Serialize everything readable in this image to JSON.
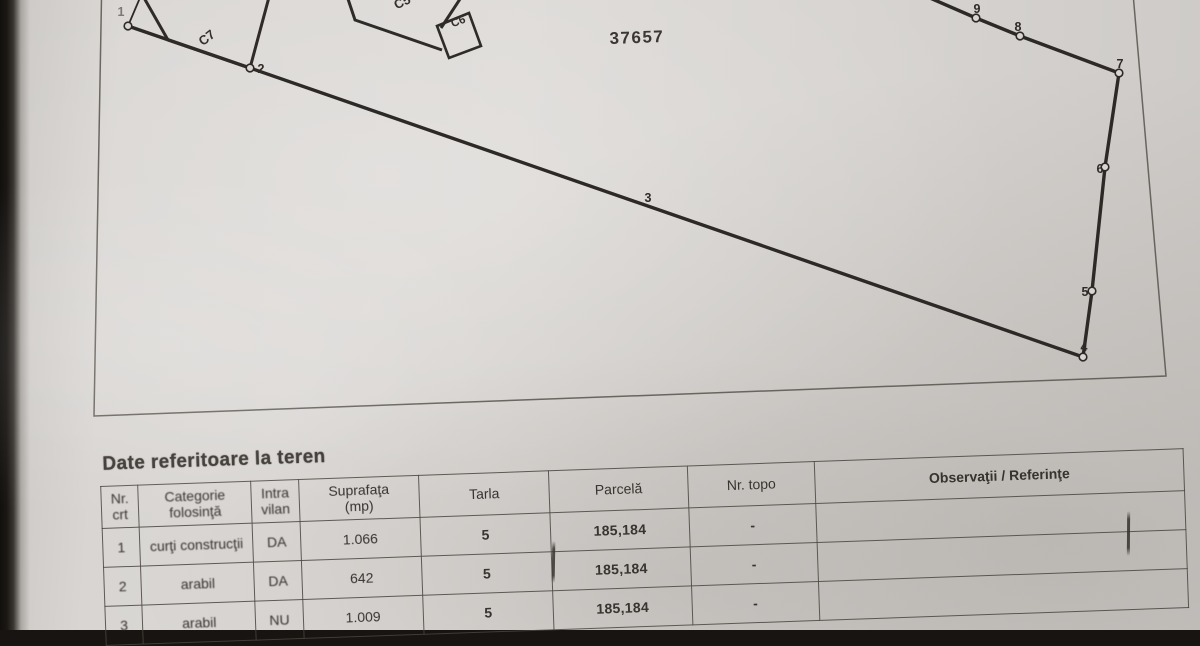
{
  "plan": {
    "sheet_number": "37657",
    "buildings": {
      "c7": "C7",
      "c5": "C5",
      "c6": "C6"
    },
    "points": {
      "p1": "1",
      "p2": "2",
      "p3": "3",
      "p4": "4",
      "p5": "5",
      "p6": "6",
      "p7": "7",
      "p8": "8",
      "p9": "9"
    }
  },
  "table": {
    "title": "Date referitoare la teren",
    "headers": {
      "nr": {
        "l1": "Nr.",
        "l2": "crt"
      },
      "categorie": {
        "l1": "Categorie",
        "l2": "folosinţă"
      },
      "intravilan": {
        "l1": "Intra",
        "l2": "vilan"
      },
      "suprafata": {
        "l1": "Suprafaţa",
        "l2": "(mp)"
      },
      "tarla": {
        "l1": "Tarla",
        "l2": ""
      },
      "parcela": {
        "l1": "Parcelă",
        "l2": ""
      },
      "nr_topo": {
        "l1": "Nr. topo",
        "l2": ""
      },
      "observatii": {
        "l1": "Observaţii / Referinţe",
        "l2": ""
      }
    },
    "rows": [
      {
        "nr": "1",
        "categorie": "curţi construcţii",
        "intravilan": "DA",
        "suprafata": "1.066",
        "tarla": "5",
        "parcela": "185,184",
        "nr_topo": "-",
        "observatii": ""
      },
      {
        "nr": "2",
        "categorie": "arabil",
        "intravilan": "DA",
        "suprafata": "642",
        "tarla": "5",
        "parcela": "185,184",
        "nr_topo": "-",
        "observatii": ""
      },
      {
        "nr": "3",
        "categorie": "arabil",
        "intravilan": "NU",
        "suprafata": "1.009",
        "tarla": "5",
        "parcela": "185,184",
        "nr_topo": "-",
        "observatii": ""
      }
    ]
  },
  "colors": {
    "paper": "#d8d5d2",
    "ink": "#2c2927",
    "frame": "#56514b"
  }
}
